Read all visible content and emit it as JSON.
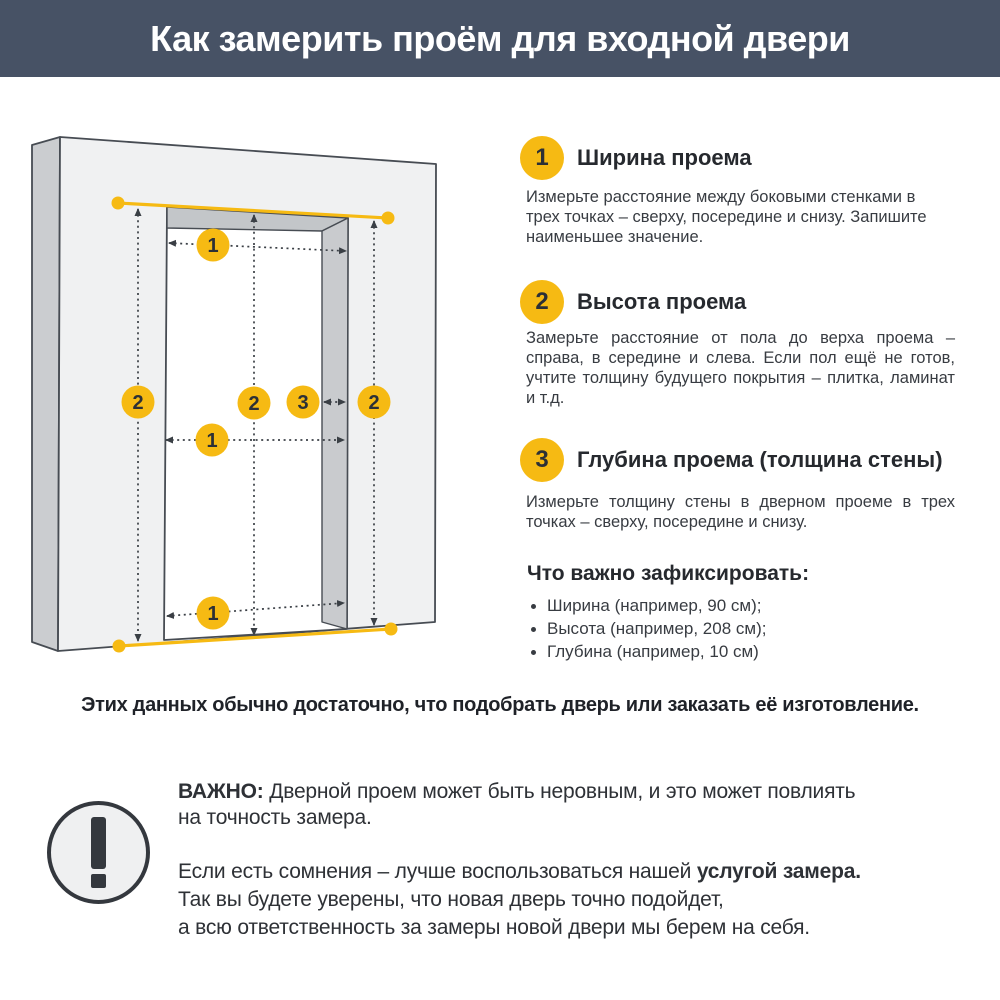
{
  "header": {
    "title": "Как замерить проём для входной двери"
  },
  "diagram": {
    "marker_labels": {
      "width": "1",
      "height": "2",
      "depth": "3"
    }
  },
  "steps": [
    {
      "number": "1",
      "title": "Ширина проема",
      "body": "Измерьте расстояние между боковыми стенками в трех точках – сверху, посередине и снизу. Запишите наименьшее значение."
    },
    {
      "number": "2",
      "title": "Высота проема",
      "body": "Замерьте расстояние от пола до верха проема – справа, в середине и слева. Если пол ещё не готов, учтите толщину будущего покрытия – плитка, ламинат и т.д."
    },
    {
      "number": "3",
      "title": "Глубина проема (толщина стены)",
      "body": "Измерьте толщину стены в дверном проеме в трех точках – сверху, посередине и снизу."
    }
  ],
  "record": {
    "title": "Что важно зафиксировать:",
    "items": [
      "Ширина (например, 90 см);",
      "Высота (например, 208 см);",
      "Глубина (например, 10 см)"
    ]
  },
  "summary": {
    "text": "Этих данных обычно достаточно, что подобрать дверь или заказать её изготовление."
  },
  "warning": {
    "line1_bold": "ВАЖНО:",
    "line1_text": " Дверной проем может быть неровным, и это может повлиять",
    "line2_text": "на точность замера.",
    "line3_text": "Если есть сомнения – лучше воспользоваться нашей ",
    "line3_bold": "услугой замера.",
    "line4_text": "Так вы будете уверены, что новая дверь точно подойдет,",
    "line5_text": "а всю ответственность за замеры новой двери мы берем на себя."
  },
  "colors": {
    "accent": "#F6BA13",
    "header_bg": "#475265"
  }
}
